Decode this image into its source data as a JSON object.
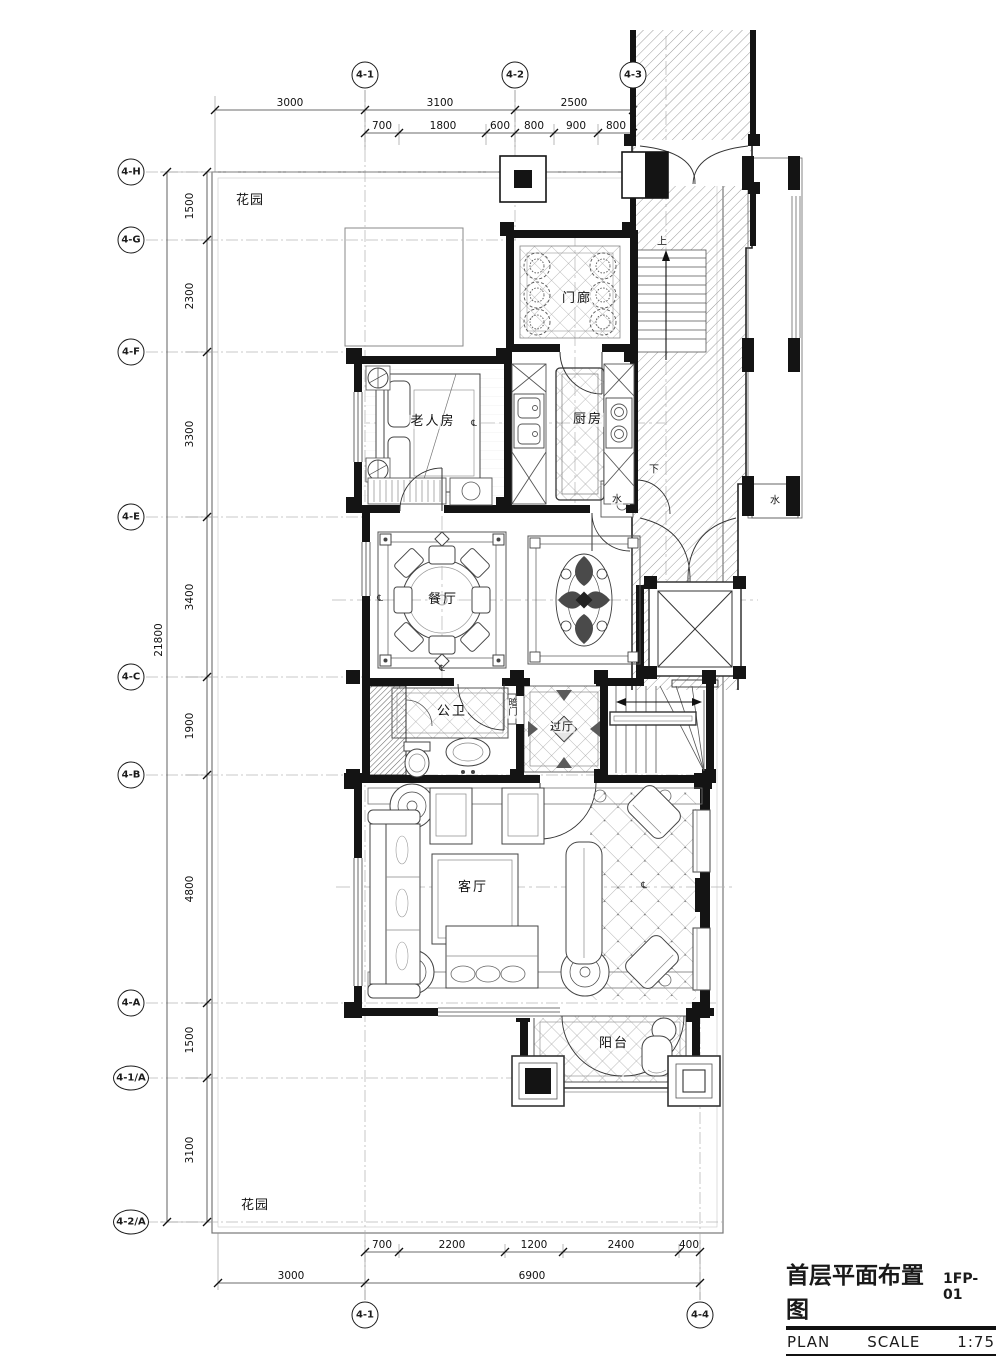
{
  "title_block": {
    "title": "首层平面布置图",
    "number": "1FP-01",
    "plan_label": "PLAN",
    "scale_label": "SCALE",
    "scale_value": "1:75"
  },
  "grid": {
    "top": [
      "4-1",
      "4-2",
      "4-3"
    ],
    "bottom": [
      "4-1",
      "4-4"
    ],
    "left": [
      "4-H",
      "4-G",
      "4-F",
      "4-E",
      "4-C",
      "4-B",
      "4-A",
      "4-1/A",
      "4-2/A"
    ]
  },
  "dims": {
    "top1": [
      "3000",
      "3100",
      "2500"
    ],
    "top2": [
      "700",
      "1800",
      "600",
      "800",
      "900",
      "800"
    ],
    "left": [
      "1500",
      "2300",
      "3300",
      "3400",
      "1900",
      "4800",
      "1500",
      "3100"
    ],
    "left_total": "21800",
    "bottom1": [
      "700",
      "2200",
      "1200",
      "2400",
      "400"
    ],
    "bottom2": [
      "3000",
      "6900"
    ]
  },
  "rooms": {
    "garden_top": "花园",
    "garden_bottom": "花园",
    "porch": "门廊",
    "elder": "老人房",
    "kitchen": "厨房",
    "dining": "餐厅",
    "bath": "公卫",
    "hidden_door": "暗门",
    "passage": "过厅",
    "living": "客厅",
    "balcony": "阳台"
  },
  "annotations": {
    "up": "上",
    "down": "下",
    "water": "水",
    "centerline": "℄"
  },
  "colors": {
    "line": "#141414",
    "hatch": "#9c9c9c",
    "tile": "#b0b0b0"
  }
}
